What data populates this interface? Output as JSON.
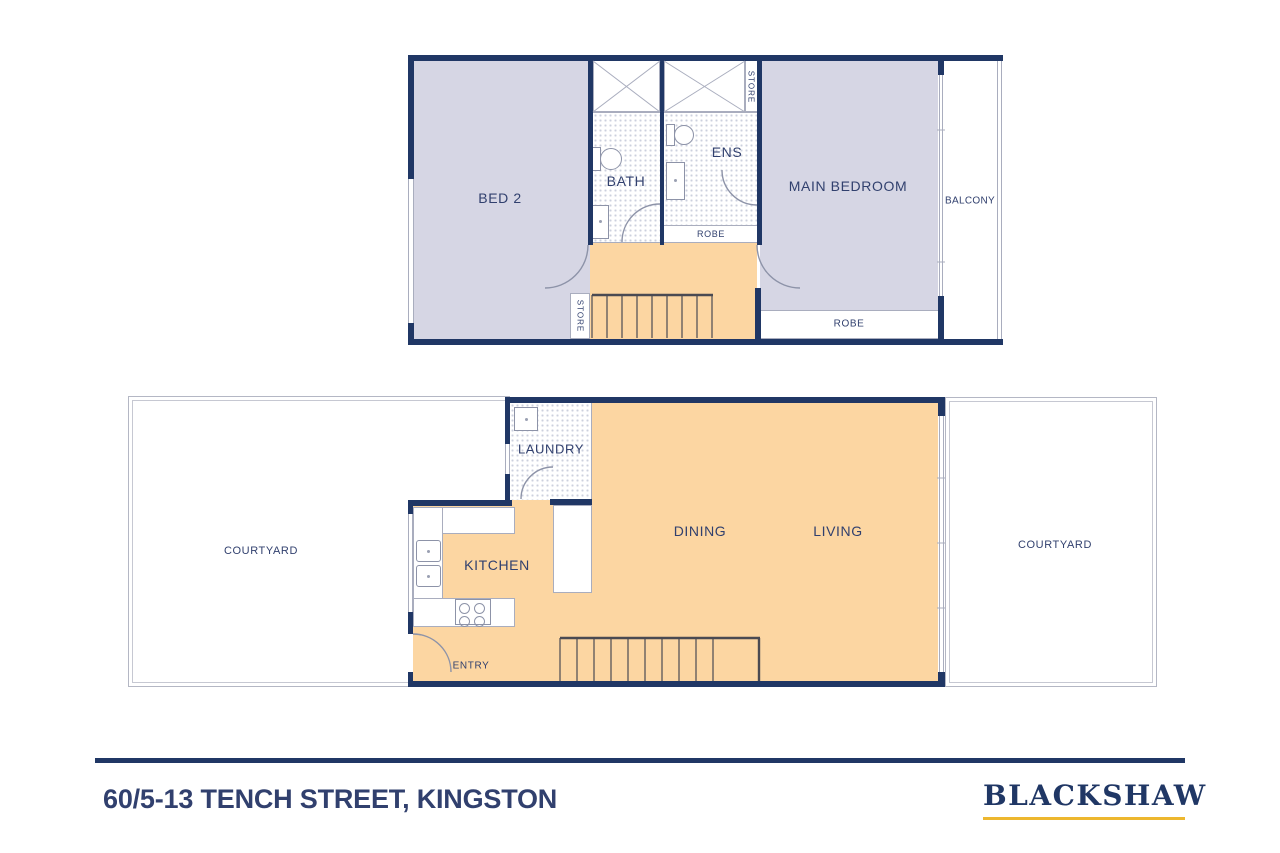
{
  "document": {
    "type": "real-estate floor plan"
  },
  "colors": {
    "wall_navy": "#203765",
    "text_navy": "#31406e",
    "room_lavender": "#d6d6e4",
    "room_orange": "#fcd6a2",
    "line_grey": "#a9adbe",
    "hatch_dot": "#ccd0de",
    "accent_gold": "#edb72f"
  },
  "plans": {
    "upper": {
      "labels": {
        "bed2": "BED 2",
        "bath": "BATH",
        "ens": "ENS",
        "robe_ens": "ROBE",
        "main_bedroom": "MAIN BEDROOM",
        "balcony": "BALCONY",
        "robe_main": "ROBE",
        "store_top": "STORE",
        "store_bottom": "STORE"
      }
    },
    "lower": {
      "labels": {
        "courtyard_left": "COURTYARD",
        "laundry": "LAUNDRY",
        "kitchen": "KITCHEN",
        "entry": "ENTRY",
        "dining": "DINING",
        "living": "LIVING",
        "courtyard_right": "COURTYARD"
      }
    }
  },
  "footer": {
    "address": "60/5-13 TENCH STREET, KINGSTON",
    "brand": "BLACKSHAW"
  }
}
